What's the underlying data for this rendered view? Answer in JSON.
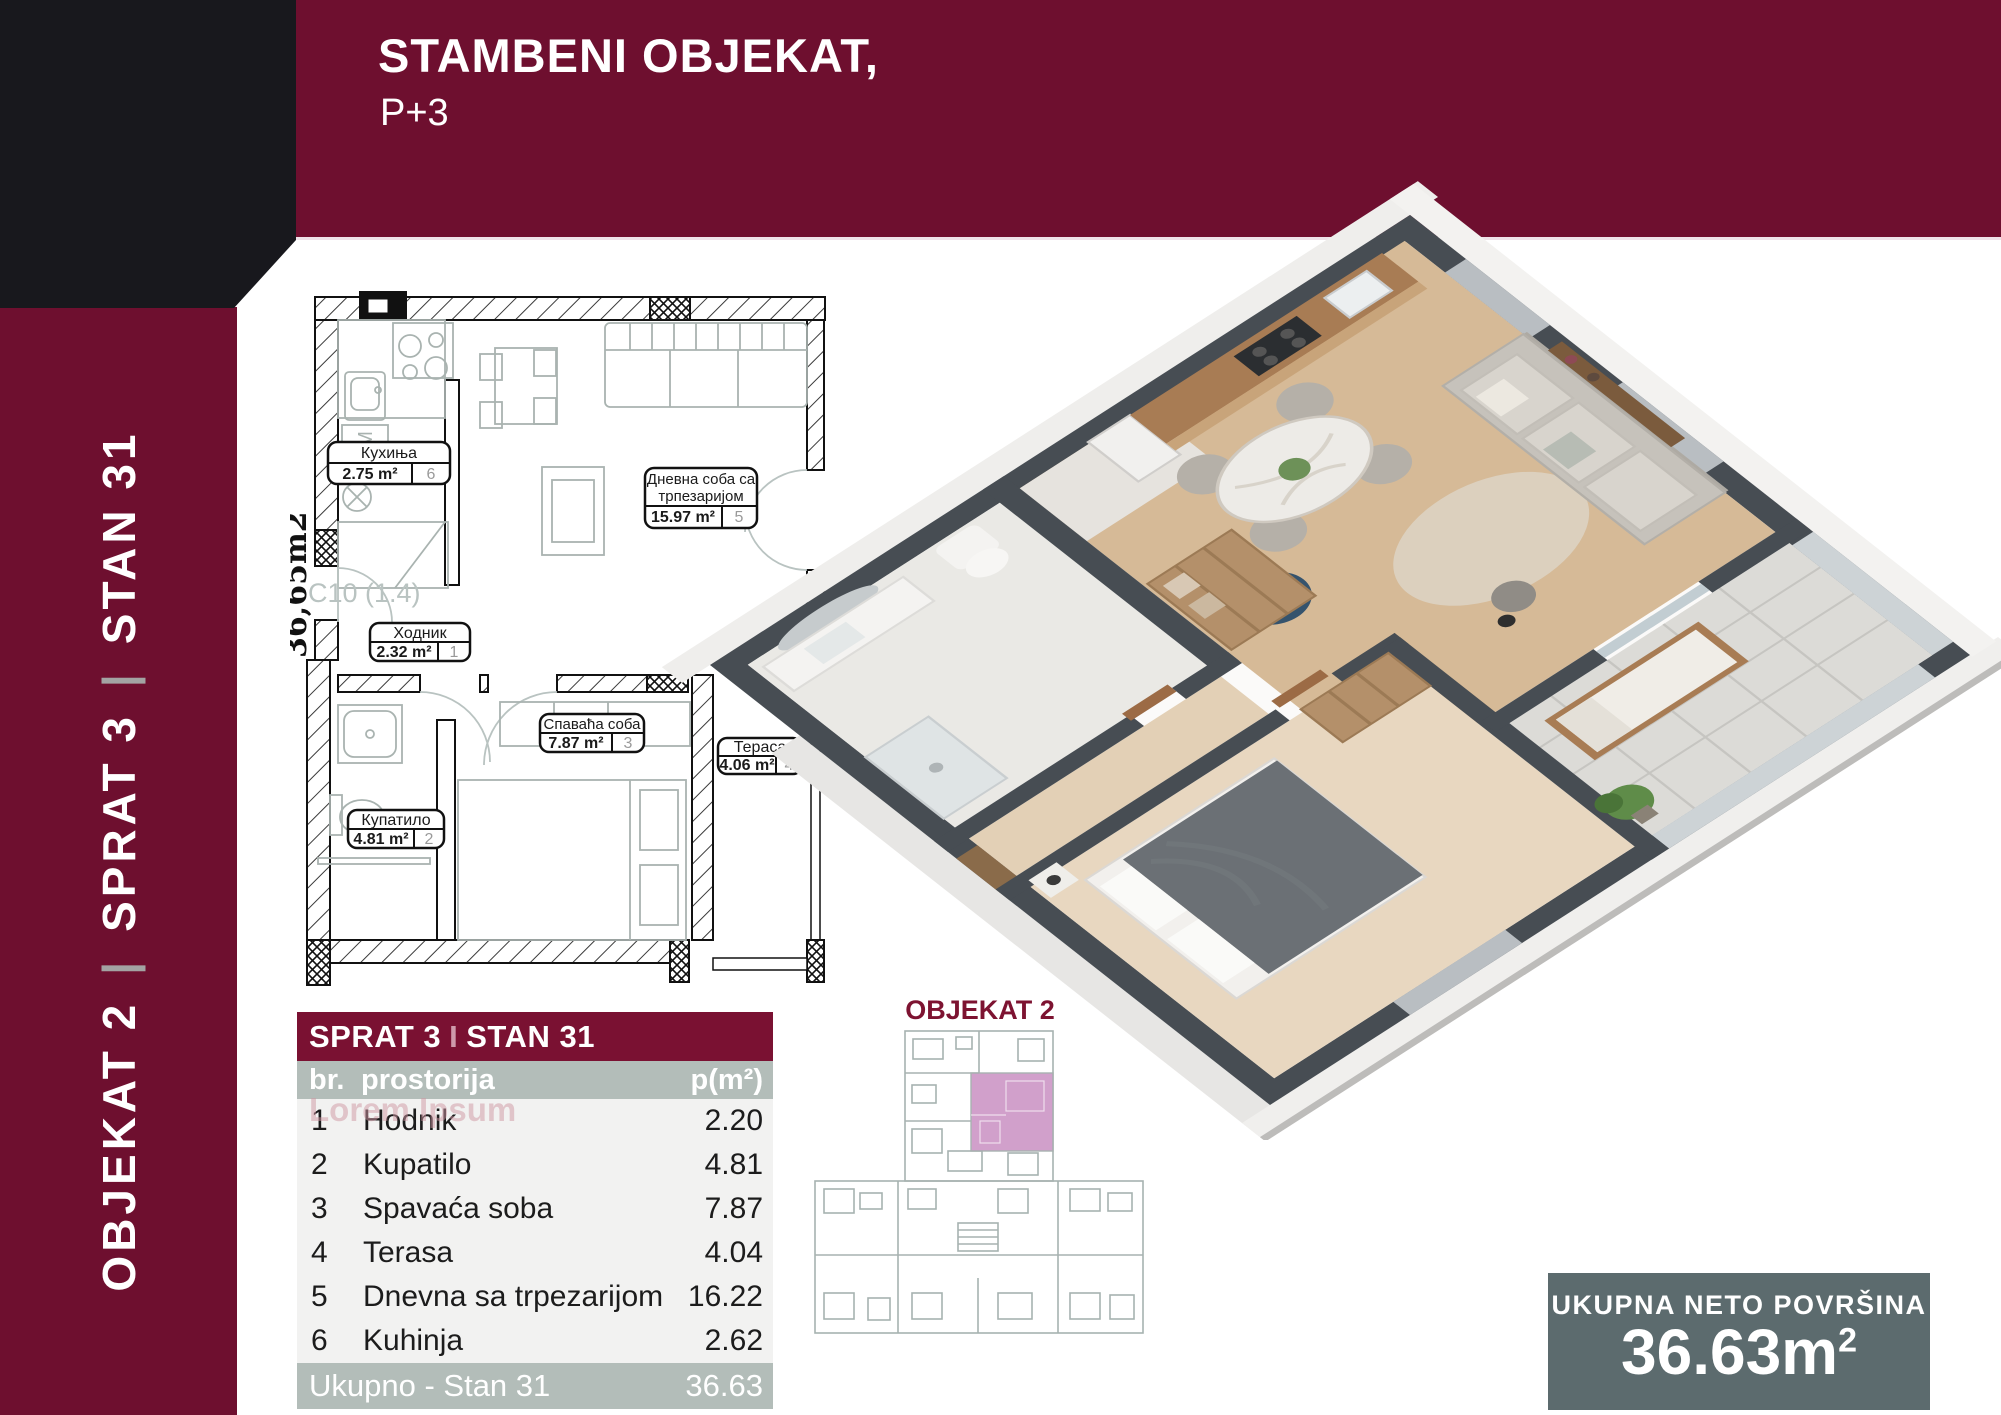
{
  "header": {
    "title": "STAMBENI OBJEKAT,",
    "subtitle": "P+3"
  },
  "sidebar": {
    "seg1": "OBJEKAT 2",
    "seg2": "SPRAT 3",
    "seg3": "STAN 31",
    "sep": "|"
  },
  "plan2d": {
    "area_vertical": "36,65m2",
    "unit_code": "C10 (1.4)",
    "cm_label": "СМ",
    "kuhinja_name": "Кухиња",
    "kuhinja_area": "2.75 m²",
    "kuhinja_num": "6",
    "dnevna_line1": "Дневна соба са",
    "dnevna_line2": "трпезаријом",
    "dnevna_area": "15.97 m²",
    "dnevna_num": "5",
    "hodnik_name": "Ходник",
    "hodnik_area": "2.32 m²",
    "hodnik_num": "1",
    "kupatilo_name": "Купатило",
    "kupatilo_area": "4.81 m²",
    "kupatilo_num": "2",
    "spavaca_name": "Спаваћа соба",
    "spavaca_area": "7.87 m²",
    "spavaca_num": "3",
    "terasa_name": "Тераса",
    "terasa_area": "4.06 m²",
    "terasa_num": "4"
  },
  "table": {
    "title_left": "SPRAT 3",
    "title_sep": "I",
    "title_right": "STAN 31",
    "col1": "br.",
    "col2": "prostorija",
    "col3": "p(m²)",
    "rows": [
      [
        "1",
        "Hodnik",
        "2.20"
      ],
      [
        "2",
        "Kupatilo",
        "4.81"
      ],
      [
        "3",
        "Spavaća soba",
        "7.87"
      ],
      [
        "4",
        "Terasa",
        "4.04"
      ],
      [
        "5",
        "Dnevna sa trpezarijom",
        "16.22"
      ],
      [
        "6",
        "Kuhinja",
        "2.62"
      ]
    ],
    "footer_label": "Ukupno - Stan 31",
    "footer_value": "36.63",
    "watermark": "Lorem Ipsum"
  },
  "minimap": {
    "title": "OBJEKAT 2"
  },
  "total": {
    "label": "UKUPNA NETO POVRŠINA",
    "value_main": "36.63m",
    "value_sup": "2"
  },
  "colors": {
    "maroon": "#6E0F2F",
    "table_title": "#7A1132",
    "gray_row": "#B3BDB9",
    "slate_box": "#5C6B6E",
    "highlight_pink": "#C98FC2",
    "wall_dark": "#474D53"
  }
}
